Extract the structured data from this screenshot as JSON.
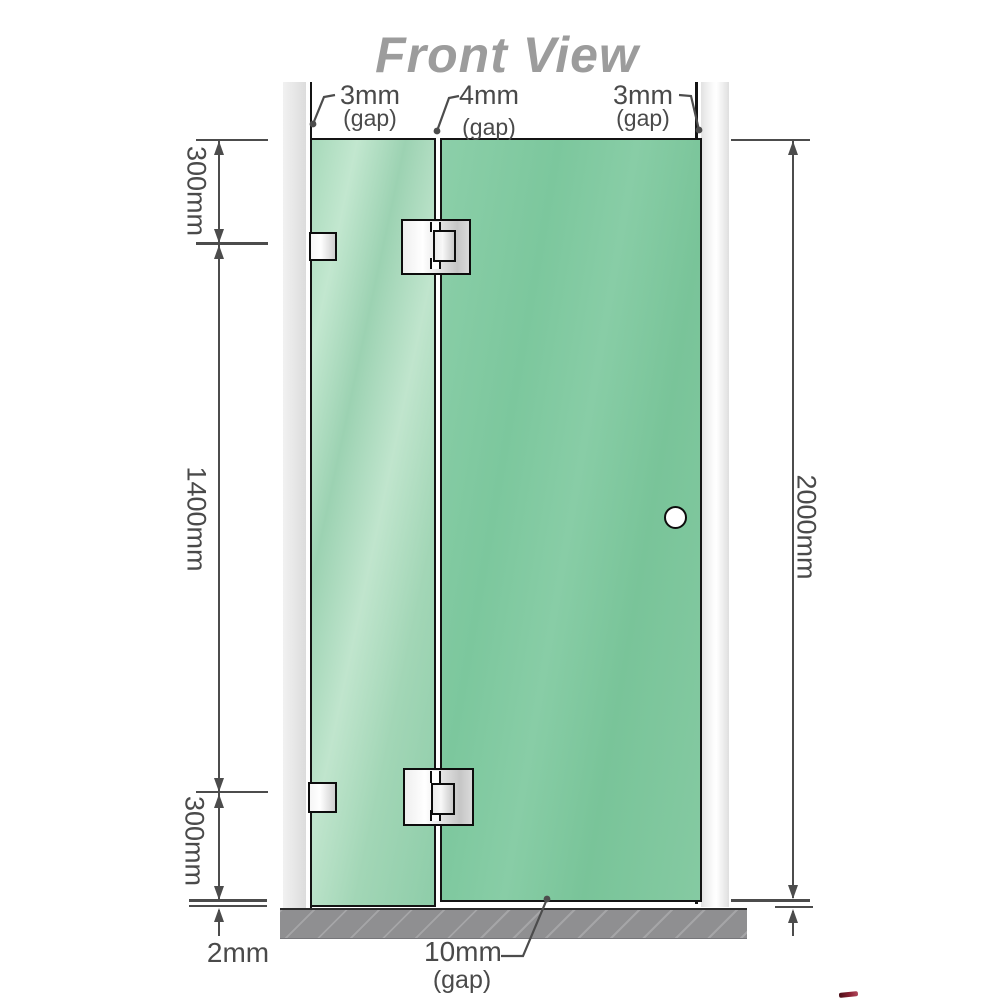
{
  "title": "Front View",
  "annotations": {
    "top_gaps": [
      {
        "value": "3mm",
        "suffix": "(gap)"
      },
      {
        "value": "4mm",
        "suffix": "(gap)"
      },
      {
        "value": "3mm",
        "suffix": "(gap)"
      }
    ],
    "left_dims": {
      "top": "300mm",
      "middle": "1400mm",
      "bottom": "300mm"
    },
    "right_dim": "2000mm",
    "floor_clearance": "2mm",
    "bottom_gap": {
      "value": "10mm",
      "suffix": "(gap)"
    }
  },
  "colors": {
    "title_gray": "#9c9c9c",
    "dimension_gray": "#4c4c4c",
    "glass_green_light": "#aaddbd",
    "glass_green": "#7ec79e",
    "wall_channel_gray": "#e9e9e9",
    "floor_gray": "#8f8f91",
    "hardware_outline": "#0d0d0d",
    "logo_red_sliver": "#8e2436"
  }
}
